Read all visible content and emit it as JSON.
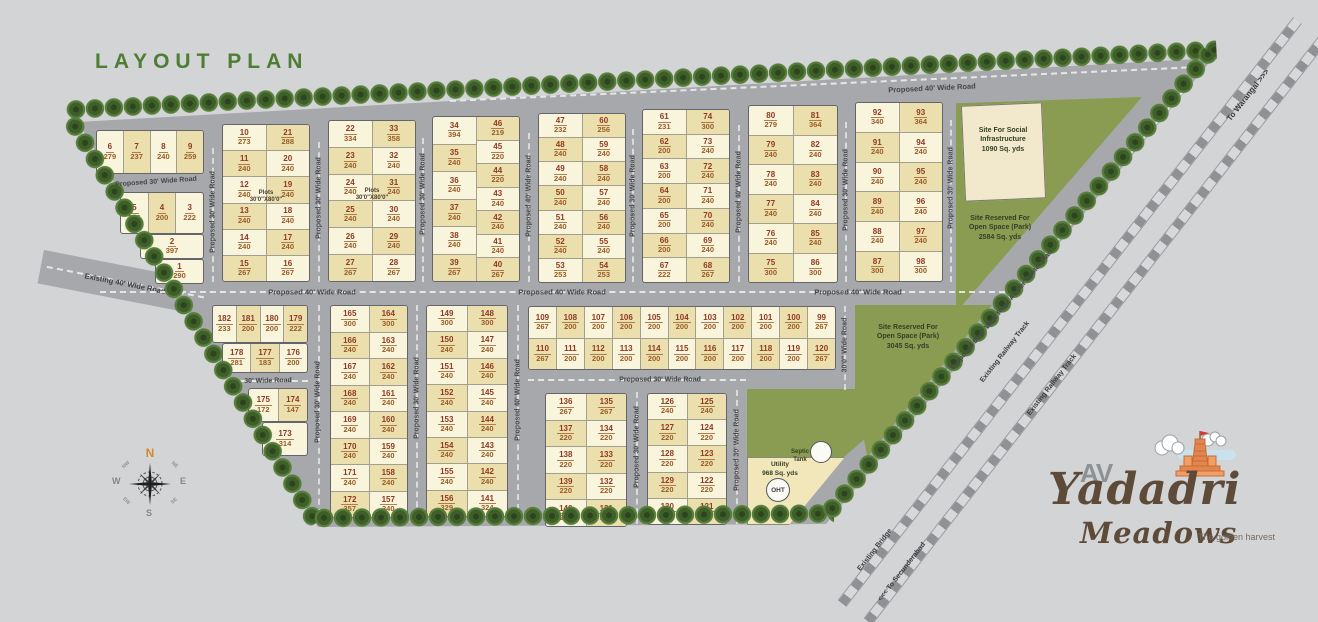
{
  "title": "LAYOUT PLAN",
  "plot_note": {
    "l1": "Plots",
    "l2": "30'0\"X80'0\""
  },
  "roads": {
    "p30": "Proposed 30' Wide Road",
    "p40": "Proposed 40' Wide Road",
    "w30": "30' Wide Road",
    "w30_0": "30'0\" Wide Road",
    "e40": "Existing 40' Wide Road",
    "p60": "Proposed 60'0\" Wide Road As Per Master Plan"
  },
  "railway": {
    "track": "Existing Railway Track",
    "warangal": "To Warangal >>>",
    "secunderabad": "<<< To Secunderabad",
    "bridge": "Existing Bridge"
  },
  "sites": {
    "social": {
      "l1": "Site For Social",
      "l2": "Infrastructure",
      "l3": "1090 Sq. yds"
    },
    "park1": {
      "l1": "Site Reserved For",
      "l2": "Open Space (Park)",
      "l3": "2584 Sq. yds"
    },
    "park2": {
      "l1": "Site Reserved For",
      "l2": "Open Space (Park)",
      "l3": "3045 Sq. yds"
    },
    "utility": {
      "l1": "Utility",
      "l2": "968 Sq. yds"
    },
    "septic": {
      "l1": "Septic",
      "l2": "Tank"
    },
    "oht": "OHT"
  },
  "compass": {
    "n": "N",
    "e": "E",
    "s": "S",
    "w": "W",
    "ne": "NE",
    "nw": "NW",
    "se": "SE",
    "sw": "SW"
  },
  "logo": {
    "av": "AV",
    "name": "Yadadri",
    "sub": "Meadows",
    "tagline": "The golden harvest"
  },
  "colors": {
    "background": "#d3d4d6",
    "road_gray": "#a7a8ab",
    "plot_light": "#f9f4dc",
    "plot_dark": "#ecdfae",
    "park_green": "#8a9c52",
    "tree_green": "#3f5f2a",
    "number_red": "#903921",
    "area_brown": "#995c26",
    "title_green": "#4e7d34",
    "logo_brown": "#5e4a38"
  },
  "plots": {
    "a_top": [
      {
        "n": 6,
        "a": 279
      },
      {
        "n": 7,
        "a": 237
      },
      {
        "n": 8,
        "a": 240
      },
      {
        "n": 9,
        "a": 259
      }
    ],
    "a_r1": [
      {
        "n": 5,
        "a": 236
      },
      {
        "n": 4,
        "a": 200
      },
      {
        "n": 3,
        "a": 222
      }
    ],
    "a_r2": [
      {
        "n": 2,
        "a": 397
      }
    ],
    "a_r3": [
      {
        "n": 1,
        "a": 290
      }
    ],
    "b1": [
      {
        "n": 10,
        "a": 273
      },
      {
        "n": 11,
        "a": 240
      },
      {
        "n": 12,
        "a": 240
      },
      {
        "n": 13,
        "a": 240
      },
      {
        "n": 14,
        "a": 240
      },
      {
        "n": 15,
        "a": 267
      }
    ],
    "b2": [
      {
        "n": 21,
        "a": 288
      },
      {
        "n": 20,
        "a": 240
      },
      {
        "n": 19,
        "a": 240
      },
      {
        "n": 18,
        "a": 240
      },
      {
        "n": 17,
        "a": 240
      },
      {
        "n": 16,
        "a": 267
      }
    ],
    "c1": [
      {
        "n": 22,
        "a": 334
      },
      {
        "n": 23,
        "a": 240
      },
      {
        "n": 24,
        "a": 240
      },
      {
        "n": 25,
        "a": 240
      },
      {
        "n": 26,
        "a": 240
      },
      {
        "n": 27,
        "a": 267
      }
    ],
    "c2": [
      {
        "n": 33,
        "a": 358
      },
      {
        "n": 32,
        "a": 240
      },
      {
        "n": 31,
        "a": 240
      },
      {
        "n": 30,
        "a": 240
      },
      {
        "n": 29,
        "a": 240
      },
      {
        "n": 28,
        "a": 267
      }
    ],
    "d1": [
      {
        "n": 34,
        "a": 394
      },
      {
        "n": 35,
        "a": 240
      },
      {
        "n": 36,
        "a": 240
      },
      {
        "n": 37,
        "a": 240
      },
      {
        "n": 38,
        "a": 240
      },
      {
        "n": 39,
        "a": 267
      }
    ],
    "d2": [
      {
        "n": 46,
        "a": 219
      },
      {
        "n": 45,
        "a": 220
      },
      {
        "n": 44,
        "a": 220
      },
      {
        "n": 43,
        "a": 240
      },
      {
        "n": 42,
        "a": 240
      },
      {
        "n": 41,
        "a": 240
      },
      {
        "n": 40,
        "a": 267
      }
    ],
    "e1": [
      {
        "n": 47,
        "a": 232
      },
      {
        "n": 48,
        "a": 240
      },
      {
        "n": 49,
        "a": 240
      },
      {
        "n": 50,
        "a": 240
      },
      {
        "n": 51,
        "a": 240
      },
      {
        "n": 52,
        "a": 240
      },
      {
        "n": 53,
        "a": 253
      }
    ],
    "e2": [
      {
        "n": 60,
        "a": 256
      },
      {
        "n": 59,
        "a": 240
      },
      {
        "n": 58,
        "a": 240
      },
      {
        "n": 57,
        "a": 240
      },
      {
        "n": 56,
        "a": 240
      },
      {
        "n": 55,
        "a": 240
      },
      {
        "n": 54,
        "a": 253
      }
    ],
    "f1": [
      {
        "n": 61,
        "a": 231
      },
      {
        "n": 62,
        "a": 200
      },
      {
        "n": 63,
        "a": 200
      },
      {
        "n": 64,
        "a": 200
      },
      {
        "n": 65,
        "a": 200
      },
      {
        "n": 66,
        "a": 200
      },
      {
        "n": 67,
        "a": 222
      }
    ],
    "f2": [
      {
        "n": 74,
        "a": 300
      },
      {
        "n": 73,
        "a": 240
      },
      {
        "n": 72,
        "a": 240
      },
      {
        "n": 71,
        "a": 240
      },
      {
        "n": 70,
        "a": 240
      },
      {
        "n": 69,
        "a": 240
      },
      {
        "n": 68,
        "a": 267
      }
    ],
    "g1": [
      {
        "n": 80,
        "a": 279
      },
      {
        "n": 79,
        "a": 240
      },
      {
        "n": 78,
        "a": 240
      },
      {
        "n": 77,
        "a": 240
      },
      {
        "n": 76,
        "a": 240
      },
      {
        "n": 75,
        "a": 300
      }
    ],
    "g2": [
      {
        "n": 81,
        "a": 364
      },
      {
        "n": 82,
        "a": 240
      },
      {
        "n": 83,
        "a": 240
      },
      {
        "n": 84,
        "a": 240
      },
      {
        "n": 85,
        "a": 240
      },
      {
        "n": 86,
        "a": 300
      }
    ],
    "h1": [
      {
        "n": 92,
        "a": 340
      },
      {
        "n": 91,
        "a": 240
      },
      {
        "n": 90,
        "a": 240
      },
      {
        "n": 89,
        "a": 240
      },
      {
        "n": 88,
        "a": 240
      },
      {
        "n": 87,
        "a": 300
      }
    ],
    "h2": [
      {
        "n": 93,
        "a": 364
      },
      {
        "n": 94,
        "a": 240
      },
      {
        "n": 95,
        "a": 240
      },
      {
        "n": 96,
        "a": 240
      },
      {
        "n": 97,
        "a": 240
      },
      {
        "n": 98,
        "a": 300
      }
    ],
    "m1": [
      {
        "n": 109,
        "a": 267
      },
      {
        "n": 108,
        "a": 200
      },
      {
        "n": 107,
        "a": 200
      },
      {
        "n": 106,
        "a": 200
      },
      {
        "n": 105,
        "a": 200
      },
      {
        "n": 104,
        "a": 200
      },
      {
        "n": 103,
        "a": 200
      },
      {
        "n": 102,
        "a": 200
      },
      {
        "n": 101,
        "a": 200
      },
      {
        "n": 100,
        "a": 200
      },
      {
        "n": 99,
        "a": 267
      }
    ],
    "m2": [
      {
        "n": 110,
        "a": 267
      },
      {
        "n": 111,
        "a": 200
      },
      {
        "n": 112,
        "a": 200
      },
      {
        "n": 113,
        "a": 200
      },
      {
        "n": 114,
        "a": 200
      },
      {
        "n": 115,
        "a": 200
      },
      {
        "n": 116,
        "a": 200
      },
      {
        "n": 117,
        "a": 200
      },
      {
        "n": 118,
        "a": 200
      },
      {
        "n": 119,
        "a": 200
      },
      {
        "n": 120,
        "a": 267
      }
    ],
    "l1": [
      {
        "n": 182,
        "a": 233
      },
      {
        "n": 181,
        "a": 200
      },
      {
        "n": 180,
        "a": 200
      },
      {
        "n": 179,
        "a": 222
      }
    ],
    "l2": [
      {
        "n": 178,
        "a": 281
      },
      {
        "n": 177,
        "a": 183
      },
      {
        "n": 176,
        "a": 200
      }
    ],
    "l3": [
      {
        "n": 175,
        "a": 172
      },
      {
        "n": 174,
        "a": 147
      }
    ],
    "l4": [
      {
        "n": 173,
        "a": 314
      }
    ],
    "q1": [
      {
        "n": 165,
        "a": 300
      },
      {
        "n": 166,
        "a": 240
      },
      {
        "n": 167,
        "a": 240
      },
      {
        "n": 168,
        "a": 240
      },
      {
        "n": 169,
        "a": 240
      },
      {
        "n": 170,
        "a": 240
      },
      {
        "n": 171,
        "a": 240
      },
      {
        "n": 172,
        "a": 357
      }
    ],
    "q2": [
      {
        "n": 164,
        "a": 300
      },
      {
        "n": 163,
        "a": 240
      },
      {
        "n": 162,
        "a": 240
      },
      {
        "n": 161,
        "a": 240
      },
      {
        "n": 160,
        "a": 240
      },
      {
        "n": 159,
        "a": 240
      },
      {
        "n": 158,
        "a": 240
      },
      {
        "n": 157,
        "a": 340
      }
    ],
    "r1": [
      {
        "n": 149,
        "a": 300
      },
      {
        "n": 150,
        "a": 240
      },
      {
        "n": 151,
        "a": 240
      },
      {
        "n": 152,
        "a": 240
      },
      {
        "n": 153,
        "a": 240
      },
      {
        "n": 154,
        "a": 240
      },
      {
        "n": 155,
        "a": 240
      },
      {
        "n": 156,
        "a": 329
      }
    ],
    "r2": [
      {
        "n": 148,
        "a": 300
      },
      {
        "n": 147,
        "a": 240
      },
      {
        "n": 146,
        "a": 240
      },
      {
        "n": 145,
        "a": 240
      },
      {
        "n": 144,
        "a": 240
      },
      {
        "n": 143,
        "a": 240
      },
      {
        "n": 142,
        "a": 240
      },
      {
        "n": 141,
        "a": 324
      }
    ],
    "s1": [
      {
        "n": 136,
        "a": 267
      },
      {
        "n": 137,
        "a": 220
      },
      {
        "n": 138,
        "a": 220
      },
      {
        "n": 139,
        "a": 220
      },
      {
        "n": 140,
        "a": 261
      }
    ],
    "s2": [
      {
        "n": 135,
        "a": 267
      },
      {
        "n": 134,
        "a": 220
      },
      {
        "n": 133,
        "a": 220
      },
      {
        "n": 132,
        "a": 220
      },
      {
        "n": 131,
        "a": 249
      }
    ],
    "t1": [
      {
        "n": 126,
        "a": 240
      },
      {
        "n": 127,
        "a": 220
      },
      {
        "n": 128,
        "a": 220
      },
      {
        "n": 129,
        "a": 220
      },
      {
        "n": 130,
        "a": 252
      }
    ],
    "t2": [
      {
        "n": 125,
        "a": 240
      },
      {
        "n": 124,
        "a": 220
      },
      {
        "n": 123,
        "a": 220
      },
      {
        "n": 122,
        "a": 220
      },
      {
        "n": 121,
        "a": 237
      }
    ]
  }
}
